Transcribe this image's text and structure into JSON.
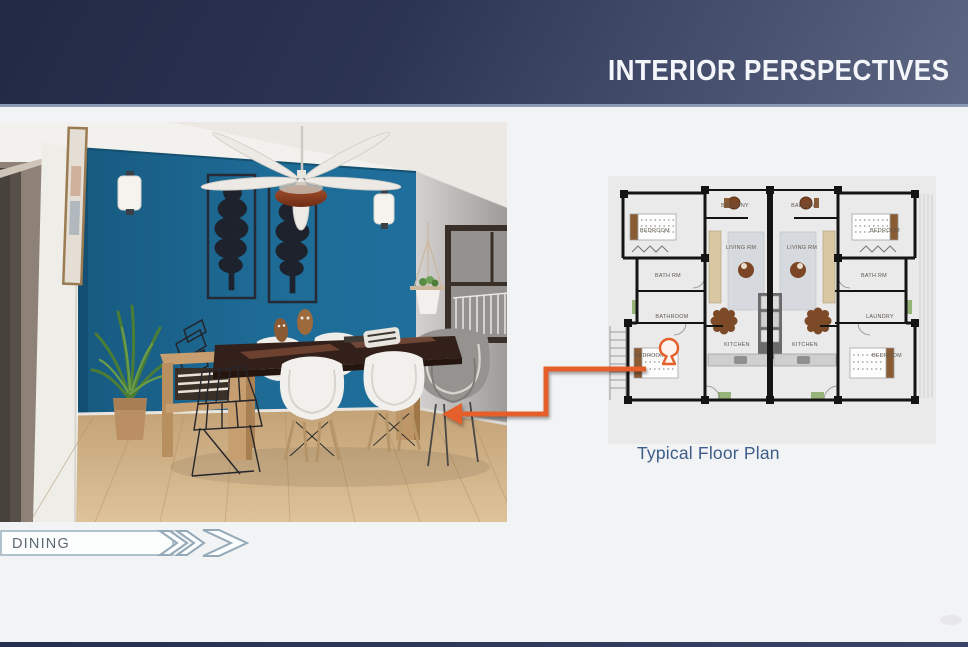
{
  "header": {
    "title": "INTERIOR PERSPECTIVES"
  },
  "tag": {
    "label": "DINING"
  },
  "floorplan": {
    "caption": "Typical Floor Plan",
    "rooms": [
      {
        "id": "bedroom-top-left",
        "label": "BEDROOM"
      },
      {
        "id": "balcony-left",
        "label": "BALCONY"
      },
      {
        "id": "balcony-right",
        "label": "BALCONY"
      },
      {
        "id": "bedroom-top-right",
        "label": "BEDROOM"
      },
      {
        "id": "living-left",
        "label": "LIVING RM"
      },
      {
        "id": "living-right",
        "label": "LIVING RM"
      },
      {
        "id": "bathrm-left",
        "label": "BATH RM"
      },
      {
        "id": "bathrm-right",
        "label": "BATH RM"
      },
      {
        "id": "bathroom-left",
        "label": "BATHROOM"
      },
      {
        "id": "laundry-right",
        "label": "LAUNDRY"
      },
      {
        "id": "kitchen-left",
        "label": "KITCHEN"
      },
      {
        "id": "kitchen-right",
        "label": "KITCHEN"
      },
      {
        "id": "bedroom-bottom-left",
        "label": "BEDROOM"
      },
      {
        "id": "bedroom-bottom-right",
        "label": "BEDROOM"
      }
    ]
  },
  "colors": {
    "accent_orange": "#E45F2B",
    "wall_blue": "#1E6B96",
    "header_navy": "#232A45",
    "caption_blue": "#3D5D8A"
  }
}
